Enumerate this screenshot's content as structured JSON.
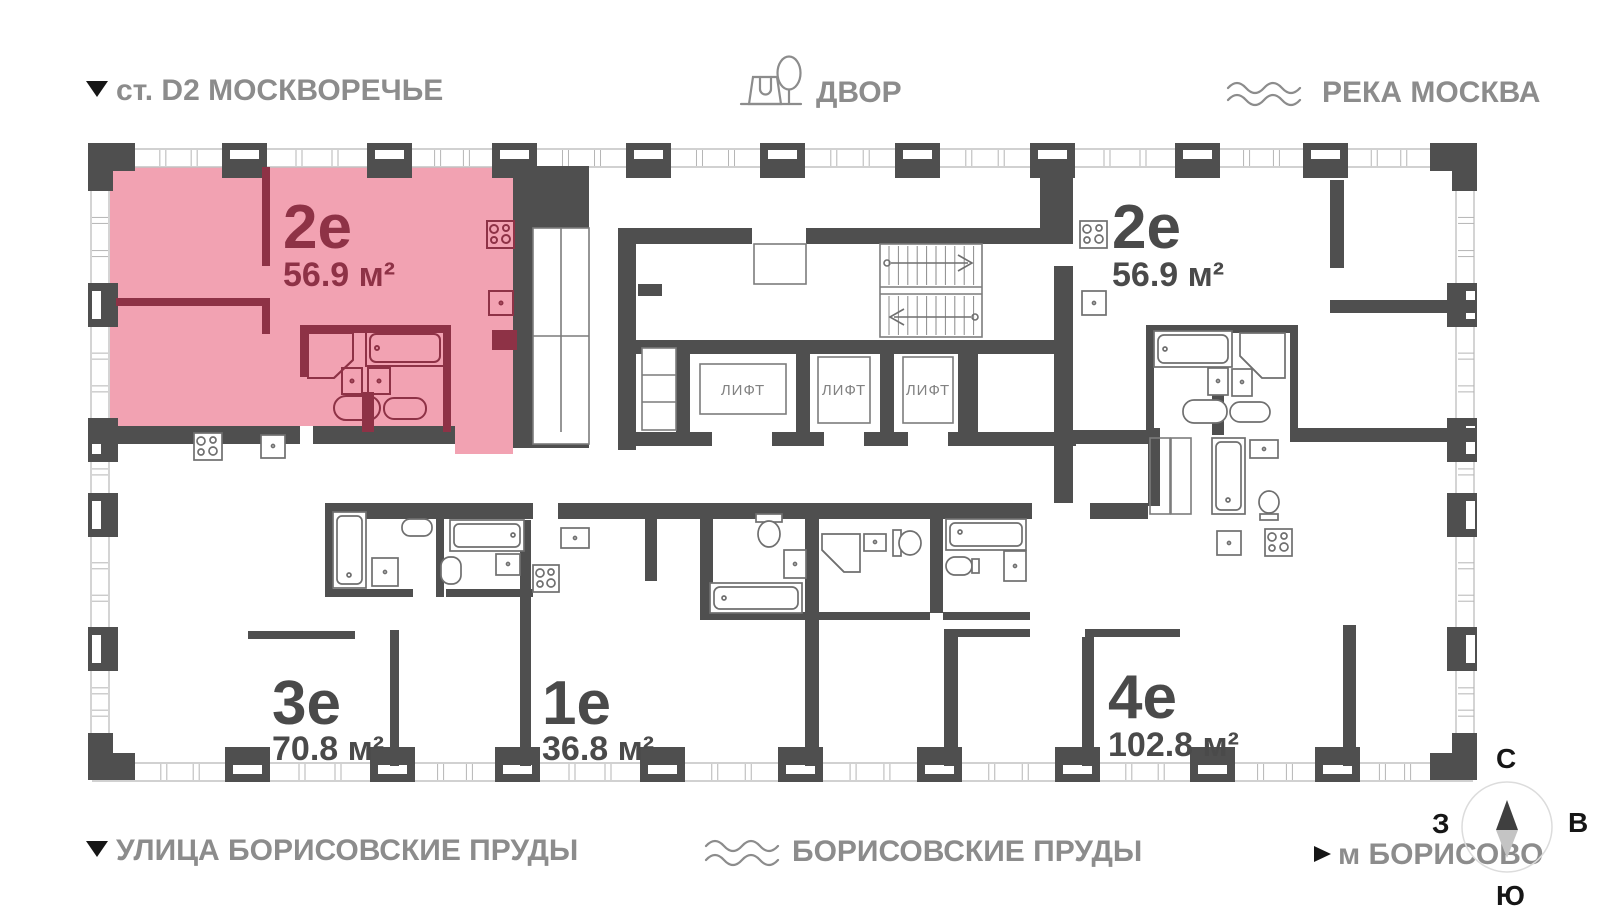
{
  "header": {
    "station": "ст. D2 МОСКВОРЕЧЬЕ",
    "courtyard": "ДВОР",
    "river": "РЕКА МОСКВА"
  },
  "footer": {
    "street": "УЛИЦА БОРИСОВСКИЕ ПРУДЫ",
    "ponds": "БОРИСОВСКИЕ ПРУДЫ",
    "metro": "м БОРИСОВО"
  },
  "compass": {
    "north": "С",
    "south": "Ю",
    "west": "З",
    "east": "В"
  },
  "apartments": [
    {
      "label": "2е",
      "area": "56.9 м²",
      "highlighted": true
    },
    {
      "label": "2е",
      "area": "56.9 м²",
      "highlighted": false
    },
    {
      "label": "3е",
      "area": "70.8 м²",
      "highlighted": false
    },
    {
      "label": "1е",
      "area": "36.8 м²",
      "highlighted": false
    },
    {
      "label": "4е",
      "area": "102.8 м²",
      "highlighted": false
    }
  ],
  "elevators": [
    {
      "label": "ЛИФТ"
    },
    {
      "label": "ЛИФТ"
    },
    {
      "label": "ЛИФТ"
    }
  ],
  "colors": {
    "highlight_fill": "#f2a2b2",
    "highlight_accent": "#8e3246",
    "wall": "#4f4f4f",
    "label_gray": "#4a4a4a",
    "muted": "#8c8c8c"
  }
}
